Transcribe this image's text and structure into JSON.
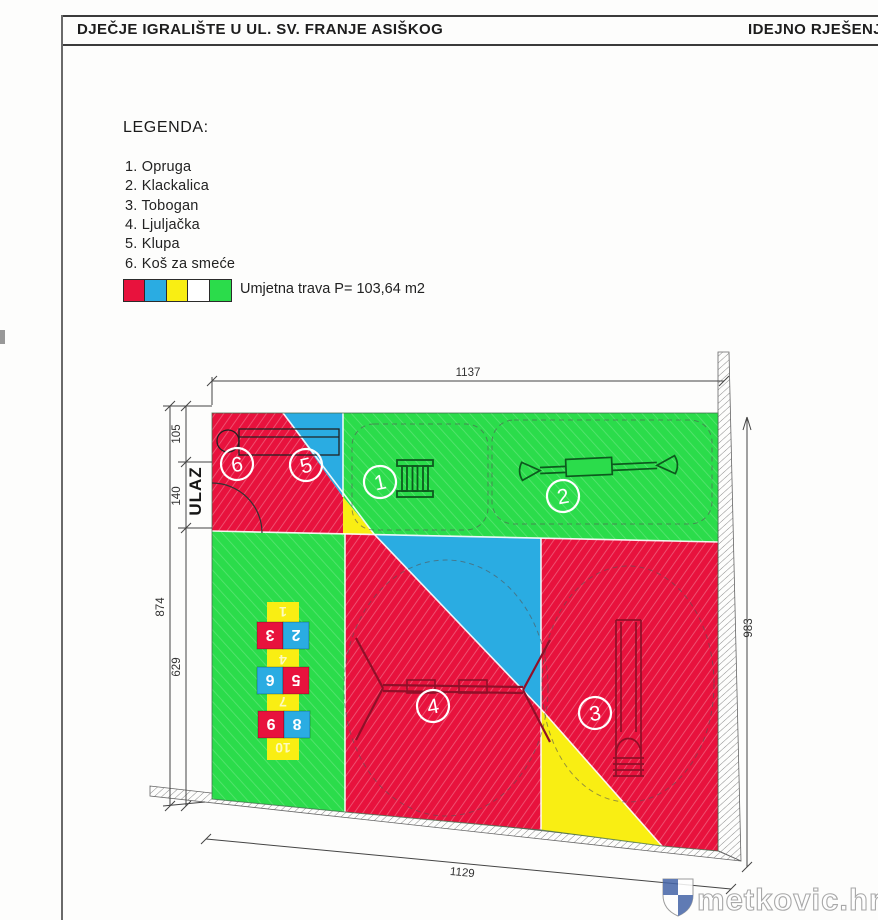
{
  "header": {
    "title": "DJEČJE IGRALIŠTE U UL. SV. FRANJE ASIŠKOG",
    "doc_type": "IDEJNO RJEŠENJE"
  },
  "legend": {
    "heading": "LEGENDA:",
    "items": [
      "1. Opruga",
      "2. Klackalica",
      "3. Tobogan",
      "4. Ljuljačka",
      "5. Klupa",
      "6. Koš za smeće"
    ],
    "grass_label": "Umjetna trava P= 103,64 m2",
    "swatch_colors": [
      "#e8123d",
      "#2aace2",
      "#f9ee13",
      "#ffffff",
      "#2bdc4b"
    ]
  },
  "plan": {
    "entrance_label": "ULAZ",
    "dimensions": {
      "top": "1137",
      "bottom": "1129",
      "right": "983",
      "left_total": "874",
      "left_segments": [
        "105",
        "140",
        "629"
      ]
    },
    "zones": {
      "m1": "1",
      "m2": "2",
      "m3": "3",
      "m4": "4",
      "m5": "5",
      "m6": "6"
    },
    "hopscotch": {
      "row1": [
        "3",
        "2"
      ],
      "row2": [
        "6",
        "5"
      ],
      "row3": [
        "9",
        "8"
      ],
      "lane": [
        "1",
        "4",
        "7",
        "10"
      ]
    }
  },
  "watermark": {
    "text": "metkovic.hr"
  },
  "palette": {
    "red": "#e8123d",
    "blue": "#2aace2",
    "yellow": "#f9ee13",
    "green": "#2bdc4b",
    "wall_line": "#8a8a8a"
  }
}
